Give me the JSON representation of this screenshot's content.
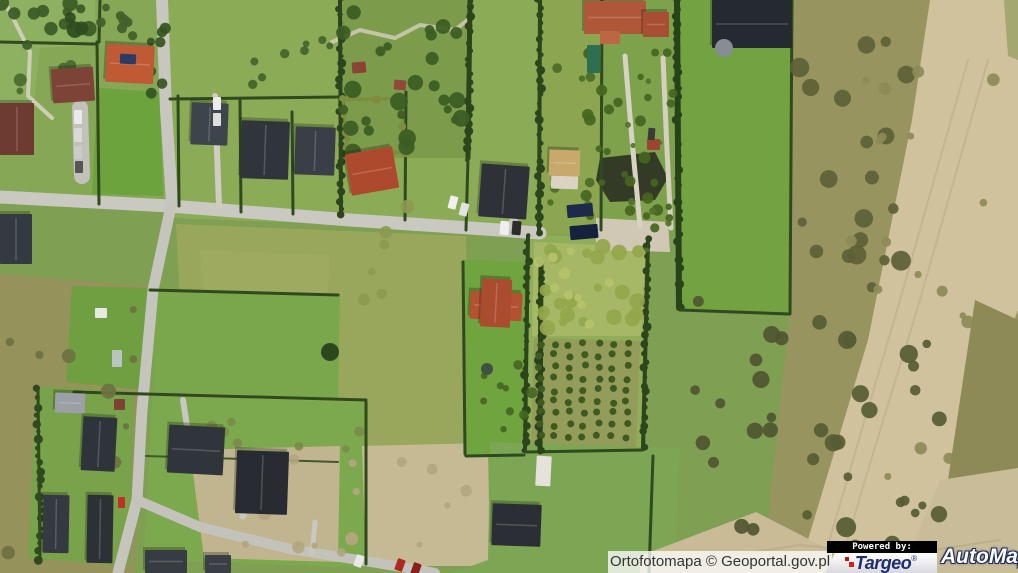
{
  "attribution": {
    "text": "Ortofotomapa © Geoportal.gov.pl"
  },
  "branding": {
    "powered_by": "Powered by:",
    "targeo": {
      "name": "Targeo",
      "reg": "®",
      "accent": "#d42020",
      "blue": "#1f2d72"
    },
    "automapa": {
      "name": "AutoMapa",
      "reg": "®",
      "outline": "#1d2b5e"
    }
  },
  "map": {
    "palette": {
      "base": "#7f9f52"
    },
    "fields": [
      {
        "p": "0,0 162,0 168,200 0,196",
        "c": "#85a756"
      },
      {
        "p": "0,0 95,0 96,45 40,48 32,120 14,150 0,152",
        "c": "#8db161"
      },
      {
        "p": "98,88 160,92 163,196 92,194",
        "c": "#6ca33d"
      },
      {
        "p": "168,0 540,0 540,232 172,218",
        "c": "#8cab57"
      },
      {
        "p": "340,0 470,0 470,158 342,158",
        "c": "#7d9c4b"
      },
      {
        "p": "176,224 466,236 469,452 188,446",
        "c": "#99a75d"
      },
      {
        "p": "200,250 330,255 325,330 205,325",
        "c": "#a3ad60",
        "o": 0.55
      },
      {
        "p": "540,0 602,0 600,234 540,234",
        "c": "#8ba550"
      },
      {
        "p": "602,0 676,0 678,232 600,232",
        "c": "#7ea24b"
      },
      {
        "p": "676,0 794,0 791,316 679,310",
        "c": "#72a340"
      },
      {
        "p": "794,0 1018,0 1018,573 698,573 768,518 789,318",
        "c": "#98945f"
      },
      {
        "p": "930,0 1018,0 1018,310 955,470 905,573 798,573 868,340 912,120",
        "c": "#cfc29d"
      },
      {
        "p": "975,300 1018,320 1018,468 948,480",
        "c": "#8d8a58"
      },
      {
        "p": "940,480 1018,468 1018,573 902,573",
        "c": "#c9bc98"
      },
      {
        "p": "0,274 150,286 134,573 0,573",
        "c": "#95925c"
      },
      {
        "p": "36,386 134,392 130,566 28,558",
        "c": "#79a34a"
      },
      {
        "p": "152,288 340,294 338,398 154,392",
        "c": "#7aa74c"
      },
      {
        "p": "72,286 150,288 146,390 66,382",
        "c": "#6f9f41"
      },
      {
        "p": "152,396 368,402 364,568 144,560",
        "c": "#7ca84e"
      },
      {
        "p": "190,450 340,446 338,562 204,558",
        "c": "#c1b590"
      },
      {
        "p": "362,446 488,443 490,566 366,566",
        "c": "#c6ba94"
      },
      {
        "p": "462,260 542,262 540,456 464,456",
        "c": "#6fa43e"
      },
      {
        "p": "528,234 650,240 644,452 524,452",
        "c": "#8fae57"
      },
      {
        "p": "534,242 646,247 641,336 532,336",
        "c": "#a6b766"
      },
      {
        "p": "534,338 640,341 636,449 531,449",
        "c": "#939c58"
      },
      {
        "p": "490,442 680,448 674,573 452,573 488,560",
        "c": "#7ca653"
      },
      {
        "p": "596,218 668,222 670,252 596,250",
        "c": "#d0c8b4"
      },
      {
        "p": "640,556 756,512 842,556 868,573 640,573",
        "c": "#c9bb95"
      },
      {
        "p": "600,158 655,152 668,178 655,200 610,202 596,180",
        "c": "#333a26"
      },
      {
        "p": "1004,0 1018,0 1018,60 1008,56",
        "c": "#9aa065",
        "o": 0.8
      }
    ],
    "roads": [
      {
        "p": "0,197 170,206 350,220 470,228 540,233",
        "w": 13,
        "c": "#cac9c1"
      },
      {
        "p": "162,0 166,110 172,202",
        "w": 12,
        "c": "#c8c7bf"
      },
      {
        "p": "171,206 153,290 142,410 137,500 118,573",
        "w": 11,
        "c": "#c6c5bd"
      },
      {
        "p": "137,500 200,527 290,549 420,570 435,573",
        "w": 10,
        "c": "#c4c3bb"
      },
      {
        "p": "625,56 632,140 640,226",
        "w": 5,
        "c": "#d7d2c3"
      },
      {
        "p": "663,58 667,150 671,228",
        "w": 5,
        "c": "#d5cfc0"
      },
      {
        "p": "510,196 513,218 516,234",
        "w": 8,
        "c": "#c8c7bf"
      },
      {
        "p": "80,108 82,176",
        "w": 16,
        "c": "#c2c1ba"
      },
      {
        "p": "215,96 219,206",
        "w": 6,
        "c": "#cfcdc3"
      },
      {
        "p": "243,516 247,472",
        "w": 7,
        "c": "#c9c8c0"
      },
      {
        "p": "312,554 315,522",
        "w": 5,
        "c": "#c9c8c0"
      },
      {
        "p": "183,400 187,426",
        "w": 6,
        "c": "#c9c8c0"
      },
      {
        "p": "8,8 30,52 28,96 52,118",
        "w": 4,
        "c": "#d8d4c4",
        "o": 0.85
      },
      {
        "p": "332,42 360,30 395,38 420,25 455,30 470,18",
        "w": 4,
        "c": "#d5d0bd",
        "o": 0.8
      },
      {
        "p": "968,60 900,300 850,470 820,573",
        "w": 2,
        "c": "#b9ab85",
        "o": 0.6
      },
      {
        "p": "988,60 920,300 865,480 838,573",
        "w": 2,
        "c": "#b9ab85",
        "o": 0.6
      },
      {
        "p": "700,560 800,545 900,555 1000,540",
        "w": 2,
        "c": "#b0a37e",
        "o": 0.5
      }
    ],
    "hedges": [
      {
        "p": "97,42 99,204",
        "w": 3,
        "c": "#2f4a1e",
        "b": 0
      },
      {
        "p": "100,0 99,42",
        "w": 3,
        "c": "#2f4a1e",
        "b": 0
      },
      {
        "p": "178,96 179,206",
        "w": 3,
        "c": "#2f4a1e",
        "b": 0
      },
      {
        "p": "240,100 241,212",
        "w": 3,
        "c": "#2f4a1e",
        "b": 0
      },
      {
        "p": "292,112 293,214",
        "w": 3,
        "c": "#2f4a1e",
        "b": 0
      },
      {
        "p": "340,0 341,216",
        "w": 4,
        "c": "#2c451c",
        "b": 1,
        "s": 3
      },
      {
        "p": "406,92 405,220",
        "w": 3,
        "c": "#2f4a1e",
        "b": 0
      },
      {
        "p": "470,0 468,158",
        "w": 5,
        "c": "#2c451c",
        "b": 1,
        "s": 5
      },
      {
        "p": "468,158 466,230",
        "w": 3,
        "c": "#2f4a1e",
        "b": 0
      },
      {
        "p": "540,0 539,232",
        "w": 4,
        "c": "#2c451c",
        "b": 1,
        "s": 7
      },
      {
        "p": "602,0 601,230",
        "w": 3,
        "c": "#2f4a1e",
        "b": 0
      },
      {
        "p": "677,0 679,308",
        "w": 6,
        "c": "#28421a",
        "b": 1,
        "s": 11
      },
      {
        "p": "792,0 790,314",
        "w": 3,
        "c": "#2f4a1e",
        "b": 0
      },
      {
        "p": "680,310 789,314",
        "w": 3,
        "c": "#2f4a1e",
        "b": 0
      },
      {
        "p": "528,236 525,450",
        "w": 4,
        "c": "#2c451c",
        "b": 1,
        "s": 13
      },
      {
        "p": "648,240 643,449",
        "w": 4,
        "c": "#2c451c",
        "b": 1,
        "s": 17
      },
      {
        "p": "526,452 643,450",
        "w": 3,
        "c": "#2f4a1e",
        "b": 0
      },
      {
        "p": "463,262 465,454",
        "w": 3,
        "c": "#2f4a1e",
        "b": 0
      },
      {
        "p": "541,262 540,452",
        "w": 5,
        "c": "#28421a",
        "b": 1,
        "s": 19
      },
      {
        "p": "170,99 339,97",
        "w": 3,
        "c": "#2f4a1e",
        "b": 0
      },
      {
        "p": "0,42 95,44",
        "w": 3,
        "c": "#2f4a1e",
        "b": 0
      },
      {
        "p": "150,290 338,295",
        "w": 3,
        "c": "#2f4a1e",
        "b": 0
      },
      {
        "p": "74,392 366,400",
        "w": 3,
        "c": "#2f4a1e",
        "b": 0
      },
      {
        "p": "38,390 40,560",
        "w": 3,
        "c": "#31491f",
        "b": 1,
        "s": 23
      },
      {
        "p": "366,402 366,564",
        "w": 3,
        "c": "#2f4a1e",
        "b": 0
      },
      {
        "p": "653,456 649,573",
        "w": 3,
        "c": "#2f4a1e",
        "b": 0
      },
      {
        "p": "146,456 338,462",
        "w": 2,
        "c": "#3d5a28",
        "b": 0
      },
      {
        "p": "466,456 524,455",
        "w": 3,
        "c": "#2f4a1e",
        "b": 0
      },
      {
        "p": "343,100 401,98 405,152",
        "w": 3,
        "c": "#7d8c3f",
        "b": 1,
        "s": 29
      },
      {
        "p": "405,152 348,156 343,100",
        "w": 3,
        "c": "#7d8c3f",
        "b": 1,
        "s": 31
      }
    ],
    "clusters": [
      {
        "x": 0,
        "y": 0,
        "w": 92,
        "h": 46,
        "n": 12,
        "r0": 4,
        "r1": 8,
        "c": "#3a5a26",
        "s": 7
      },
      {
        "x": 96,
        "y": 0,
        "w": 62,
        "h": 42,
        "n": 7,
        "r0": 3,
        "r1": 6,
        "c": "#41602a",
        "s": 11
      },
      {
        "x": 342,
        "y": 2,
        "w": 126,
        "h": 152,
        "n": 26,
        "r0": 4,
        "r1": 9,
        "c": "#3b5c23",
        "s": 23
      },
      {
        "x": 150,
        "y": 0,
        "w": 18,
        "h": 100,
        "n": 7,
        "r0": 3,
        "r1": 6,
        "c": "#35541f",
        "s": 31
      },
      {
        "x": 585,
        "y": 42,
        "w": 88,
        "h": 186,
        "n": 30,
        "r0": 3,
        "r1": 6,
        "c": "#45651f",
        "s": 43
      },
      {
        "x": 536,
        "y": 244,
        "w": 106,
        "h": 88,
        "n": 22,
        "r0": 4,
        "r1": 8,
        "c": "#93a64b",
        "s": 53
      },
      {
        "x": 536,
        "y": 246,
        "w": 106,
        "h": 84,
        "n": 10,
        "r0": 3,
        "r1": 6,
        "c": "#b6c26d",
        "s": 59
      },
      {
        "x": 798,
        "y": 30,
        "w": 120,
        "h": 266,
        "n": 20,
        "r0": 4,
        "r1": 10,
        "c": "#5c6136",
        "s": 61
      },
      {
        "x": 792,
        "y": 320,
        "w": 150,
        "h": 230,
        "n": 24,
        "r0": 4,
        "r1": 10,
        "c": "#565c33",
        "s": 67
      },
      {
        "x": 690,
        "y": 300,
        "w": 120,
        "h": 240,
        "n": 14,
        "r0": 4,
        "r1": 9,
        "c": "#4f5531",
        "s": 71
      },
      {
        "x": 4,
        "y": 292,
        "w": 132,
        "h": 262,
        "n": 12,
        "r0": 3,
        "r1": 8,
        "c": "#6c7241",
        "s": 79
      },
      {
        "x": 470,
        "y": 336,
        "w": 68,
        "h": 112,
        "n": 9,
        "r0": 3,
        "r1": 6,
        "c": "#456722",
        "s": 83
      },
      {
        "x": 546,
        "y": 44,
        "w": 48,
        "h": 178,
        "n": 10,
        "r0": 3,
        "r1": 5,
        "c": "#4c6b26",
        "s": 89
      },
      {
        "x": 352,
        "y": 206,
        "w": 60,
        "h": 120,
        "n": 6,
        "r0": 3,
        "r1": 7,
        "c": "#8a9a50",
        "s": 97
      },
      {
        "x": 205,
        "y": 420,
        "w": 240,
        "h": 30,
        "n": 7,
        "r0": 3,
        "r1": 6,
        "c": "#7b8c49",
        "s": 101
      },
      {
        "x": 842,
        "y": 60,
        "w": 160,
        "h": 440,
        "n": 18,
        "r0": 3,
        "r1": 7,
        "c": "#8d8a58",
        "s": 103
      },
      {
        "x": 200,
        "y": 455,
        "w": 280,
        "h": 100,
        "n": 16,
        "r0": 3,
        "r1": 7,
        "c": "#b3a67f",
        "s": 107
      },
      {
        "x": 620,
        "y": 60,
        "w": 52,
        "h": 200,
        "n": 8,
        "r0": 2,
        "r1": 4,
        "c": "#55712c",
        "s": 109
      },
      {
        "x": 60,
        "y": 0,
        "w": 30,
        "h": 40,
        "n": 3,
        "r0": 5,
        "r1": 9,
        "c": "#2f4c1e",
        "s": 113
      },
      {
        "x": 16,
        "y": 60,
        "w": 70,
        "h": 80,
        "n": 6,
        "r0": 3,
        "r1": 7,
        "c": "#4a6a2e",
        "s": 131
      },
      {
        "x": 240,
        "y": 20,
        "w": 90,
        "h": 70,
        "n": 8,
        "r0": 3,
        "r1": 7,
        "c": "#43632a",
        "s": 137
      }
    ],
    "grids": [
      {
        "x": 540,
        "y": 344,
        "cols": 7,
        "rows": 9,
        "dx": 14.5,
        "dy": 11.5,
        "r": 3.5,
        "c": "#3f5a20",
        "j": 2,
        "s": 5
      }
    ],
    "houses": [
      [
        0,
        103,
        34,
        52,
        "#6e3b31",
        0
      ],
      [
        52,
        68,
        42,
        34,
        "#7d4336",
        -4
      ],
      [
        106,
        45,
        48,
        38,
        "#bf5a35",
        3
      ],
      [
        0,
        214,
        32,
        50,
        "#343a42",
        0
      ],
      [
        348,
        150,
        48,
        42,
        "#ad4a2e",
        -10
      ],
      [
        191,
        103,
        37,
        42,
        "#3e444c",
        2
      ],
      [
        241,
        121,
        48,
        58,
        "#30353c",
        2
      ],
      [
        295,
        127,
        40,
        48,
        "#3a3f47",
        2
      ],
      [
        480,
        165,
        48,
        53,
        "#2e3238",
        4
      ],
      [
        549,
        150,
        31,
        26,
        "#c8a96b",
        2
      ],
      [
        584,
        1,
        62,
        33,
        "#b0573a",
        0
      ],
      [
        643,
        12,
        26,
        25,
        "#a84f33",
        0
      ],
      [
        712,
        0,
        80,
        48,
        "#252a31",
        0
      ],
      [
        470,
        292,
        52,
        28,
        "#b35231",
        3
      ],
      [
        481,
        279,
        30,
        48,
        "#ab4c2e",
        3
      ],
      [
        492,
        504,
        49,
        42,
        "#2b2f35",
        2
      ],
      [
        82,
        417,
        34,
        54,
        "#2f343b",
        3
      ],
      [
        43,
        495,
        26,
        58,
        "#343942",
        1
      ],
      [
        87,
        495,
        26,
        68,
        "#2c3137",
        1
      ],
      [
        168,
        426,
        56,
        48,
        "#30353c",
        3
      ],
      [
        236,
        451,
        52,
        63,
        "#282c32",
        2
      ],
      [
        145,
        550,
        42,
        23,
        "#373c43",
        0
      ],
      [
        205,
        555,
        26,
        18,
        "#3a3f46",
        0
      ],
      [
        55,
        393,
        30,
        20,
        "#9aa0a6",
        2
      ]
    ],
    "rects": [
      [
        551,
        176,
        27,
        13,
        "#d9d3c4",
        2
      ],
      [
        600,
        31,
        20,
        13,
        "#bd6643",
        0
      ],
      [
        567,
        204,
        26,
        13,
        "#1e2a4a",
        -5
      ],
      [
        570,
        225,
        28,
        14,
        "#16213d",
        -5
      ],
      [
        120,
        54,
        16,
        10,
        "#2a3c66",
        3
      ],
      [
        536,
        456,
        15,
        30,
        "#e4e2da",
        3
      ],
      [
        114,
        399,
        11,
        11,
        "#7e4234",
        0
      ],
      [
        647,
        139,
        13,
        11,
        "#9c4530",
        0
      ],
      [
        352,
        62,
        14,
        11,
        "#8a4434",
        -5
      ],
      [
        394,
        80,
        12,
        10,
        "#91473a",
        5
      ],
      [
        95,
        308,
        12,
        10,
        "#e8e8e2",
        0
      ],
      [
        112,
        350,
        10,
        17,
        "#b9c4bf",
        0
      ],
      [
        587,
        45,
        13,
        28,
        "#2f6e51",
        0
      ],
      [
        74,
        110,
        8,
        14,
        "#e9e9e9",
        0
      ],
      [
        74,
        128,
        8,
        14,
        "#d9d9d9",
        0
      ],
      [
        74,
        146,
        8,
        13,
        "#cbcbcb",
        0
      ],
      [
        75,
        161,
        8,
        12,
        "#565656",
        0
      ],
      [
        213,
        97,
        8,
        13,
        "#ececec",
        0
      ],
      [
        213,
        113,
        8,
        13,
        "#dddddd",
        0
      ],
      [
        449,
        196,
        8,
        13,
        "#f0f0f0",
        15
      ],
      [
        460,
        203,
        8,
        13,
        "#e2e2e2",
        15
      ],
      [
        500,
        221,
        9,
        14,
        "#efefef",
        5
      ],
      [
        512,
        221,
        9,
        14,
        "#2c2c2c",
        5
      ],
      [
        118,
        497,
        7,
        11,
        "#c03028",
        0
      ],
      [
        396,
        559,
        8,
        12,
        "#b02820",
        20
      ],
      [
        412,
        563,
        8,
        12,
        "#8a1f1a",
        20
      ],
      [
        355,
        555,
        8,
        12,
        "#e8e8e8",
        20
      ],
      [
        648,
        128,
        7,
        12,
        "#3a3a3a",
        5
      ]
    ],
    "circles": [
      [
        724,
        48,
        9,
        "#868d95"
      ],
      [
        487,
        369,
        6,
        "#3e5243"
      ],
      [
        330,
        352,
        9,
        "#2e481d"
      ]
    ]
  }
}
